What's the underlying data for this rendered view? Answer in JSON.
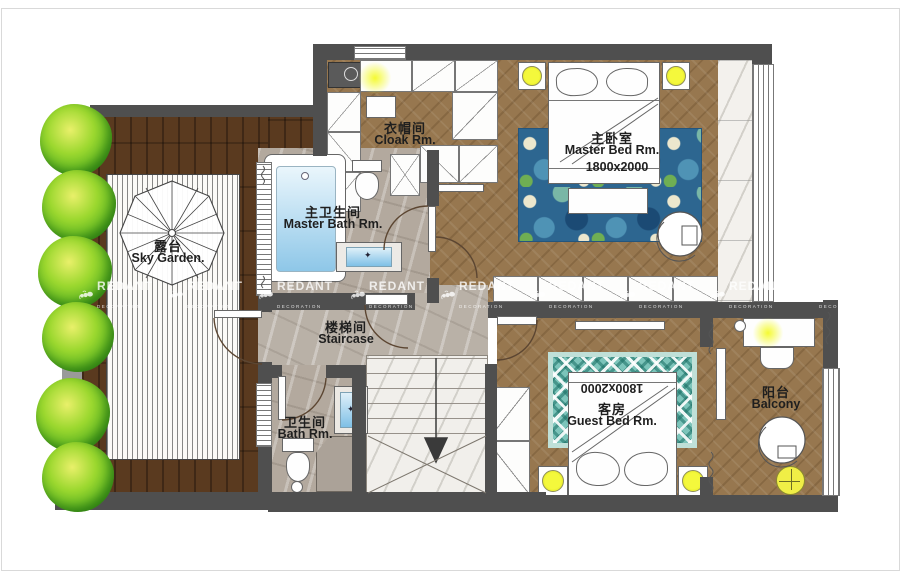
{
  "watermark": {
    "brand": "REDANT",
    "subtitle": "DECORATION"
  },
  "rooms": {
    "sky_garden": {
      "zh": "露台",
      "en": "Sky Garden."
    },
    "cloak": {
      "zh": "衣帽间",
      "en": "Cloak  Rm."
    },
    "master_bed": {
      "zh": "主卧室",
      "en": "Master Bed  Rm.",
      "bed_size": "1800x2000"
    },
    "master_bath": {
      "zh": "主卫生间",
      "en": "Master Bath Rm."
    },
    "staircase": {
      "zh": "楼梯间",
      "en": "Staircase"
    },
    "bath": {
      "zh": "卫生间",
      "en": "Bath Rm."
    },
    "guest_bed": {
      "zh": "客房",
      "en": "Guest Bed  Rm.",
      "bed_size": "1800x2000"
    },
    "balcony": {
      "zh": "阳台",
      "en": "Balcony"
    }
  },
  "colors": {
    "wall": "#4f4f4f",
    "wood_floor": "#97774f",
    "deck": "#5a3a1f",
    "light_accent": "#f2f63c",
    "rug_master": "#2d6690",
    "rug_guest": "#7cc4ba",
    "tree": "#6fbf2a",
    "water": "#8ec7e8"
  }
}
